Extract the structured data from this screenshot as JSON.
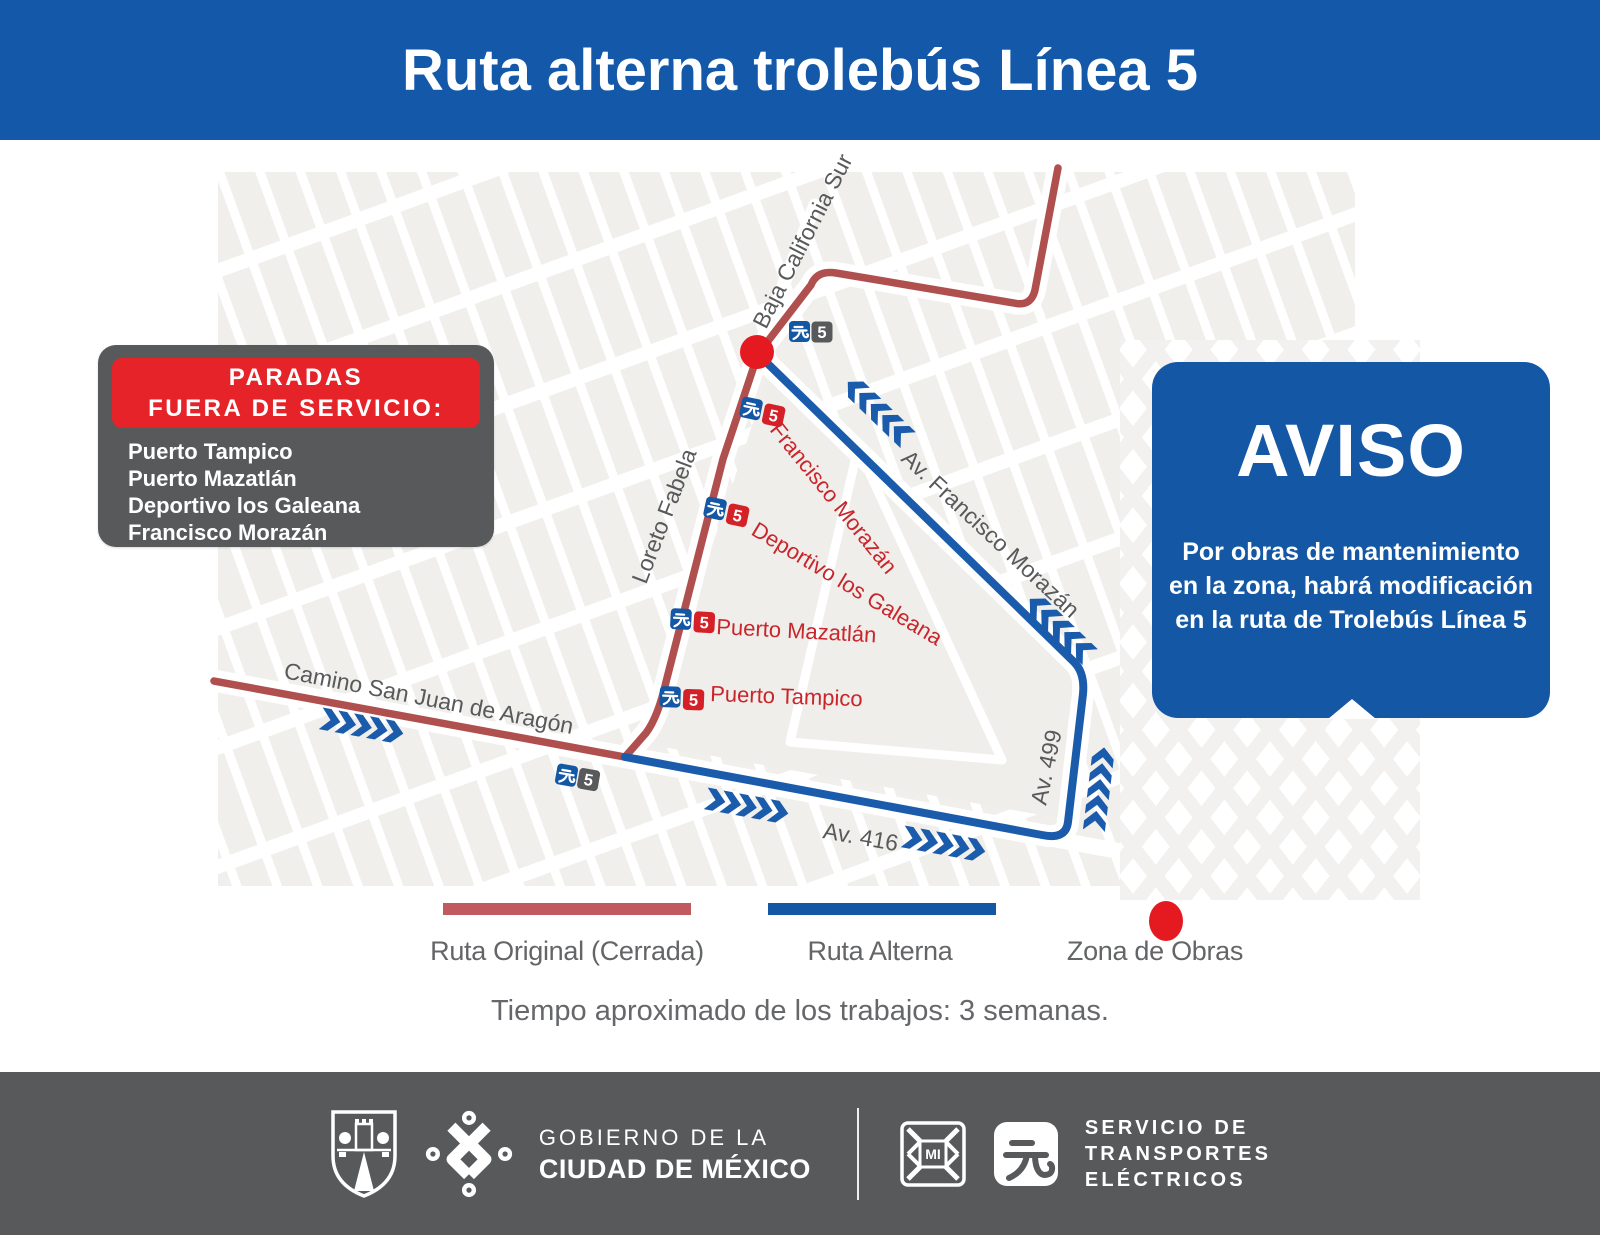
{
  "page_title": "Ruta alterna trolebús Línea 5",
  "out_of_service": {
    "title_line1": "PARADAS",
    "title_line2": "FUERA DE SERVICIO:",
    "stops": [
      "Puerto Tampico",
      "Puerto Mazatlán",
      "Deportivo los Galeana",
      "Francisco Morazán"
    ]
  },
  "notice": {
    "title": "AVISO",
    "body_lines": [
      "Por obras de mantenimiento",
      "en la zona, habrá modificación",
      "en la ruta de Trolebús Línea 5"
    ]
  },
  "map": {
    "line_number": "5",
    "streets": {
      "baja": "Baja California Sur",
      "morazan": "Av. Francisco Morazán",
      "loreto": "Loreto Fabela",
      "camino": "Camino San Juan de Aragón",
      "av416": "Av. 416",
      "av499": "Av. 499"
    },
    "closed_stops": {
      "morazan": "Francisco Morazán",
      "deportivo": "Deportivo los Galeana",
      "mazatlan": "Puerto Mazatlán",
      "tampico": "Puerto Tampico"
    }
  },
  "legend": {
    "original": "Ruta Original (Cerrada)",
    "alterna": "Ruta Alterna",
    "obras": "Zona de Obras"
  },
  "footnote": "Tiempo aproximado de los trabajos: 3 semanas.",
  "footer": {
    "gov_line1": "GOBIERNO DE LA",
    "gov_line2": "CIUDAD DE MÉXICO",
    "agency_line1": "SERVICIO DE",
    "agency_line2": "TRANSPORTES",
    "agency_line3": "ELÉCTRICOS"
  },
  "colors": {
    "header_blue": "#1459a9",
    "notice_blue": "#1457a5",
    "route_blue": "#1a5cab",
    "route_red": "#b0504e",
    "alert_red": "#e62329",
    "stop_red": "#d42127",
    "zone_dot_red": "#e41a20",
    "dark_gray": "#58595b",
    "map_block_gray": "#f0efec"
  }
}
